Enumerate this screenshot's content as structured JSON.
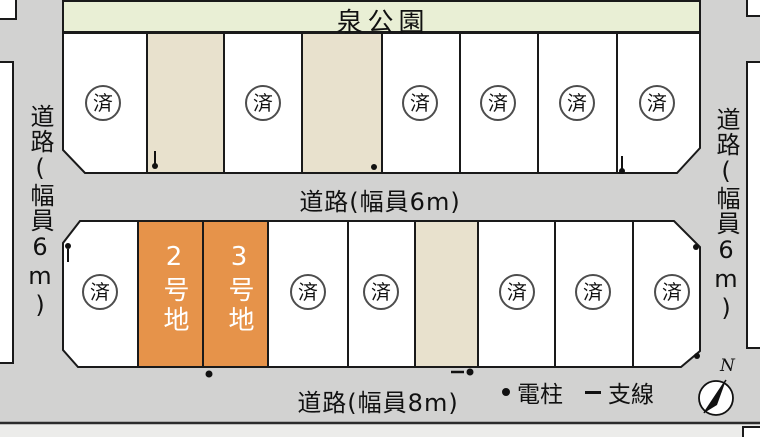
{
  "park": {
    "label": "泉公園"
  },
  "roads": {
    "left": {
      "label": "道路(幅員6m)"
    },
    "right": {
      "label": "道路(幅員6m)"
    },
    "middle": {
      "label": "道路(幅員6m)"
    },
    "bottom": {
      "label": "道路(幅員8m)"
    }
  },
  "lots": {
    "sold_mark": "済",
    "top_row_status": [
      "済",
      "",
      "済",
      "",
      "済",
      "済",
      "済",
      "済"
    ],
    "bottom_row_status": [
      "済",
      "2号地",
      "3号地",
      "済",
      "済",
      "",
      "済",
      "済",
      "済"
    ],
    "available": [
      {
        "label": "2号地"
      },
      {
        "label": "3号地"
      }
    ]
  },
  "legend": {
    "pole_label": "電柱",
    "wire_label": "支線"
  },
  "compass": {
    "north_label": "N"
  },
  "colors": {
    "lot_available": "#e6934a",
    "lot_reserved": "#e8e1cd",
    "lot_sold": "#ffffff",
    "road": "#d2d2d1",
    "park": "#e9efd5",
    "outline": "#1a1a1a"
  }
}
